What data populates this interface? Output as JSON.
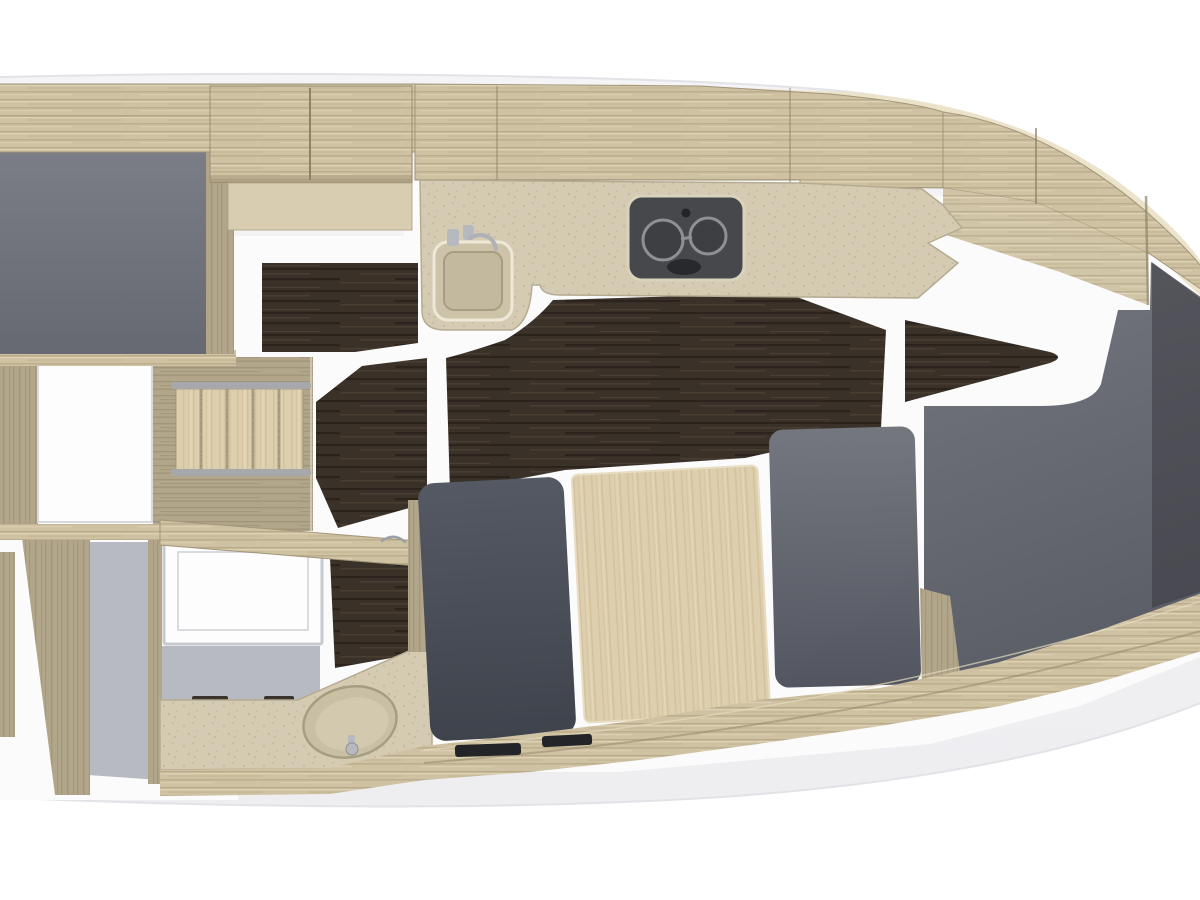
{
  "scene": {
    "type": "yacht-interior-floorplan-render",
    "view": "top-down",
    "orientation": "bow-right"
  },
  "palette": {
    "page_white": "#ffffff",
    "hull_white": "#f4f4f6",
    "hull_edge": "#e2e3e6",
    "deck_cream": "#ebe2c8",
    "wood_light": "#cfc2a2",
    "wood_grain": "#b0a281",
    "wood_highlight": "#e4dabd",
    "wood_mid": "#b2a68a",
    "wood_mid_grain": "#968b70",
    "wood_pale": "#ddcfae",
    "wood_pale_grain": "#c9b791",
    "wood_dark_edge": "#8f8268",
    "counter_beige": "#d4cbb2",
    "counter_speckle": "#bfb598",
    "counter_edge": "#aca288",
    "floor_dark": "#3a3129",
    "floor_streak_dark": "#281f19",
    "floor_streak_light": "#4e4234",
    "gray_settee": "#7b7e86",
    "gray_settee_dark": "#666971",
    "gray_berth": "#74777f",
    "gray_berth_dark": "#5b5e67",
    "gray_seatback": "#555963",
    "gray_seatback_dark": "#3f434c",
    "gray_floor": "#b7bac1",
    "wall_white": "#fdfdfe",
    "wall_edge": "#c6c9ce",
    "stove_body": "#47484c",
    "stove_ring": "#94969a",
    "stove_dark": "#232427",
    "chrome": "#b6b9be",
    "walkway_white": "#fbfbfc"
  },
  "regions": {
    "hull": "hull outline",
    "forward_settee": "forward settee cushion",
    "forward_berth": "forward berth mattress",
    "forward_wardrobe": "forward wardrobe cabinet",
    "companionway_stairs": "companionway steps",
    "galley_counter": "galley countertop",
    "galley_sink": "galley sink",
    "cooktop": "two-burner cooktop",
    "salon_floor": "dark wood salon sole",
    "head_compartment": "head with vanity basin",
    "salon_table": "salon table panel",
    "aft_berth_small": "aft single berth cushion",
    "aft_berth_large": "aft double berth cushion",
    "bow_cabinets": "bow storage cabinets",
    "base_trim": "lower hull cabinetry trim"
  }
}
